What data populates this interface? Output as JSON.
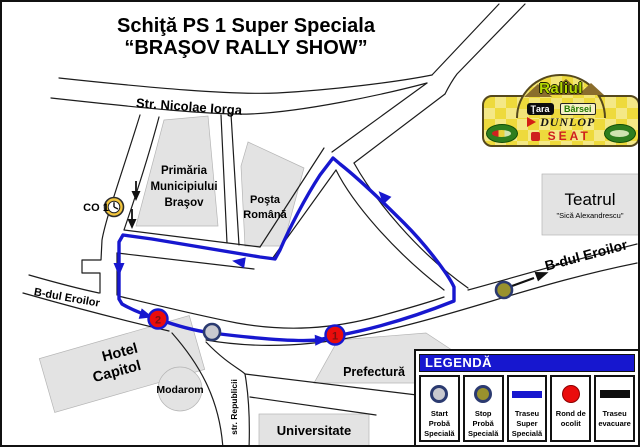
{
  "title": {
    "line1": "Schiţă PS 1 Super Speciala",
    "line2": "“BRAŞOV RALLY SHOW”"
  },
  "plate": {
    "event_name": "Raliul",
    "region_word1": "Ţara",
    "region_word2": "Bârsei",
    "sponsor_tyres": "DUNLOP",
    "sponsor_car": "SEAT"
  },
  "map": {
    "streets": {
      "nicolae_iorga": "Str. Nicolae Iorga",
      "eroilor_west": "B-dul Eroilor",
      "eroilor_east": "B-dul Eroilor",
      "republicii": "str. Republicii"
    },
    "buildings": {
      "primaria_l1": "Primăria",
      "primaria_l2": "Municipiului",
      "primaria_l3": "Braşov",
      "posta_l1": "Poşta",
      "posta_l2": "Română",
      "teatrul": "Teatrul",
      "teatrul_sub": "\"Sică Alexandrescu\"",
      "hotel_l1": "Hotel",
      "hotel_l2": "Capitol",
      "modarom": "Modarom",
      "prefectura": "Prefectură",
      "universitate": "Universitate"
    },
    "markers": {
      "co1_label": "CO 1",
      "rond1_number": "1",
      "rond2_number": "2"
    }
  },
  "legend": {
    "title": "LEGENDĂ",
    "items": [
      {
        "label": "Start\nProbă\nSpecială"
      },
      {
        "label": "Stop\nProbă\nSpecială"
      },
      {
        "label": "Traseu\nSuper\nSpecială"
      },
      {
        "label": "Rond de\nocolit"
      },
      {
        "label": "Traseu\nevacuare"
      }
    ]
  },
  "colors": {
    "route_blue": "#1717cf",
    "legend_header_blue": "#1717cf",
    "rond_red": "#ea0c0c",
    "start_gray": "#c9c9cf",
    "stop_olive": "#99922e",
    "marker_ring_navy": "#2b3a70",
    "building_gray": "#e3e3e3",
    "plate_yellow": "#eeda3c"
  }
}
